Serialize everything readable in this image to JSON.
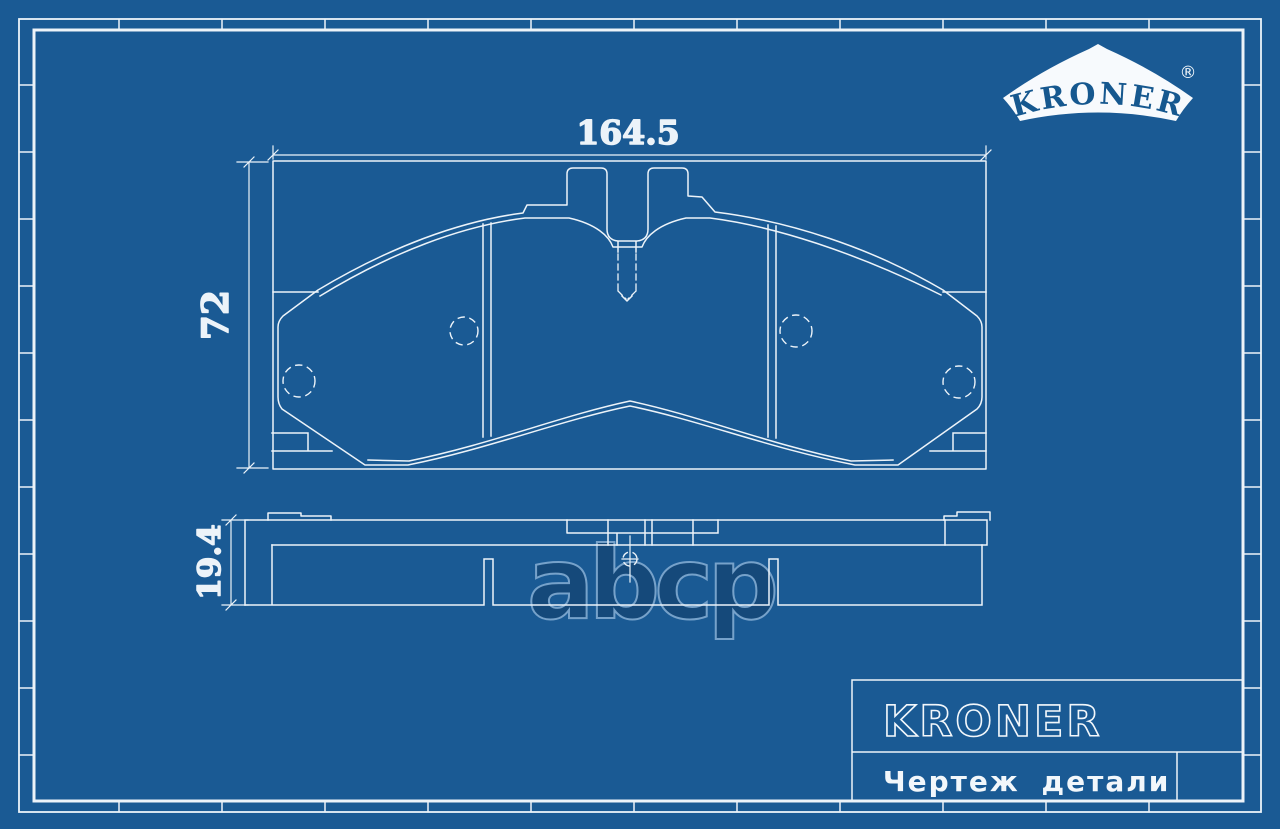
{
  "colors": {
    "background": "#1A5A94",
    "line": "#ECF3F9",
    "logo_banner": "#F7FAFD",
    "logo_text": "#16588F",
    "watermark_fill": "#154878",
    "watermark_stroke": "#7FA9D0"
  },
  "logo": {
    "brand": "KRONER",
    "registered_mark": "®"
  },
  "drawing": {
    "width_mm": "164.5",
    "height_mm": "72",
    "thickness_mm": "19.4"
  },
  "watermark": {
    "text": "abcp"
  },
  "title_block": {
    "brand": "KRONER",
    "caption": "Чертеж детали"
  }
}
